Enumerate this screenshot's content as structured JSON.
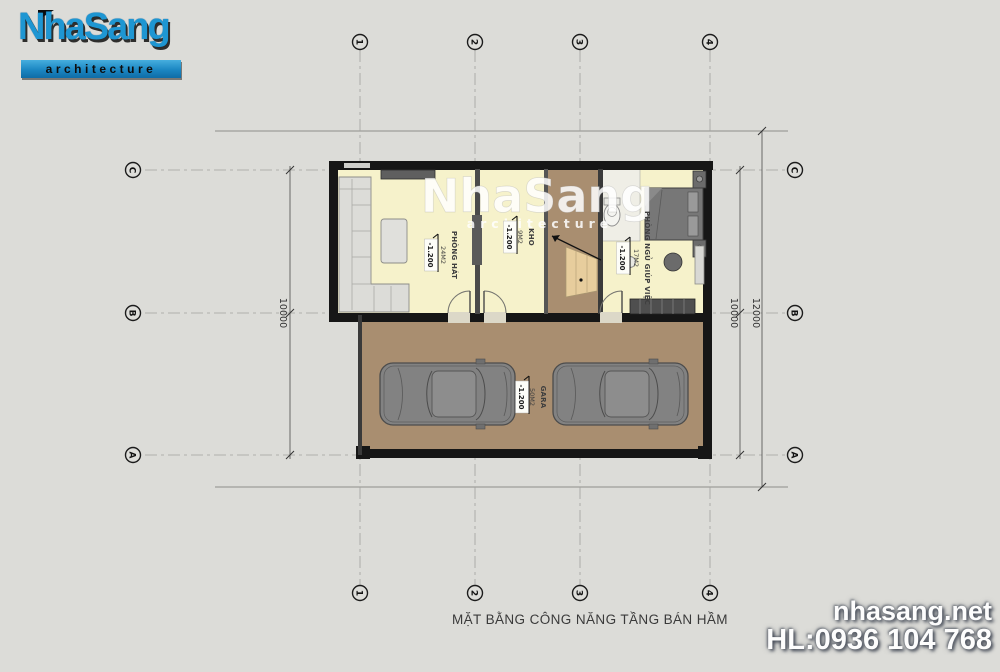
{
  "logo": {
    "brand": "NhaSang",
    "tagline": "architecture"
  },
  "watermark": {
    "brand": "NhaSang",
    "tagline": "architecture"
  },
  "plan": {
    "rooms": [
      {
        "name": "PHÒNG HÁT",
        "area": "24M2",
        "level": "-1.200"
      },
      {
        "name": "KHO",
        "area": "9M2",
        "level": "-1.200"
      },
      {
        "name": "PHÒNG NGỦ GIÚP VIỆC",
        "area": "17M2",
        "level": "-1.200"
      },
      {
        "name": "GARA",
        "area": "50M2",
        "level": "-1.200"
      }
    ],
    "grid": {
      "columns": [
        "1",
        "2",
        "3",
        "4"
      ],
      "rows": [
        "C",
        "B",
        "A"
      ]
    },
    "dimensions": {
      "left": "10000",
      "right_inner": "10000",
      "right_outer": "12000"
    }
  },
  "footer": {
    "caption": "MẶT BẰNG CÔNG NĂNG TẦNG BÁN HẦM"
  },
  "contact": {
    "website": "nhasang.net",
    "hotline": "HL:0936 104 768"
  },
  "colors": {
    "logo_blue": "#1e96d2",
    "floor_yellow": "#f6f2cb",
    "garage_brown": "#a98e70",
    "background": "#dcdcd8"
  }
}
